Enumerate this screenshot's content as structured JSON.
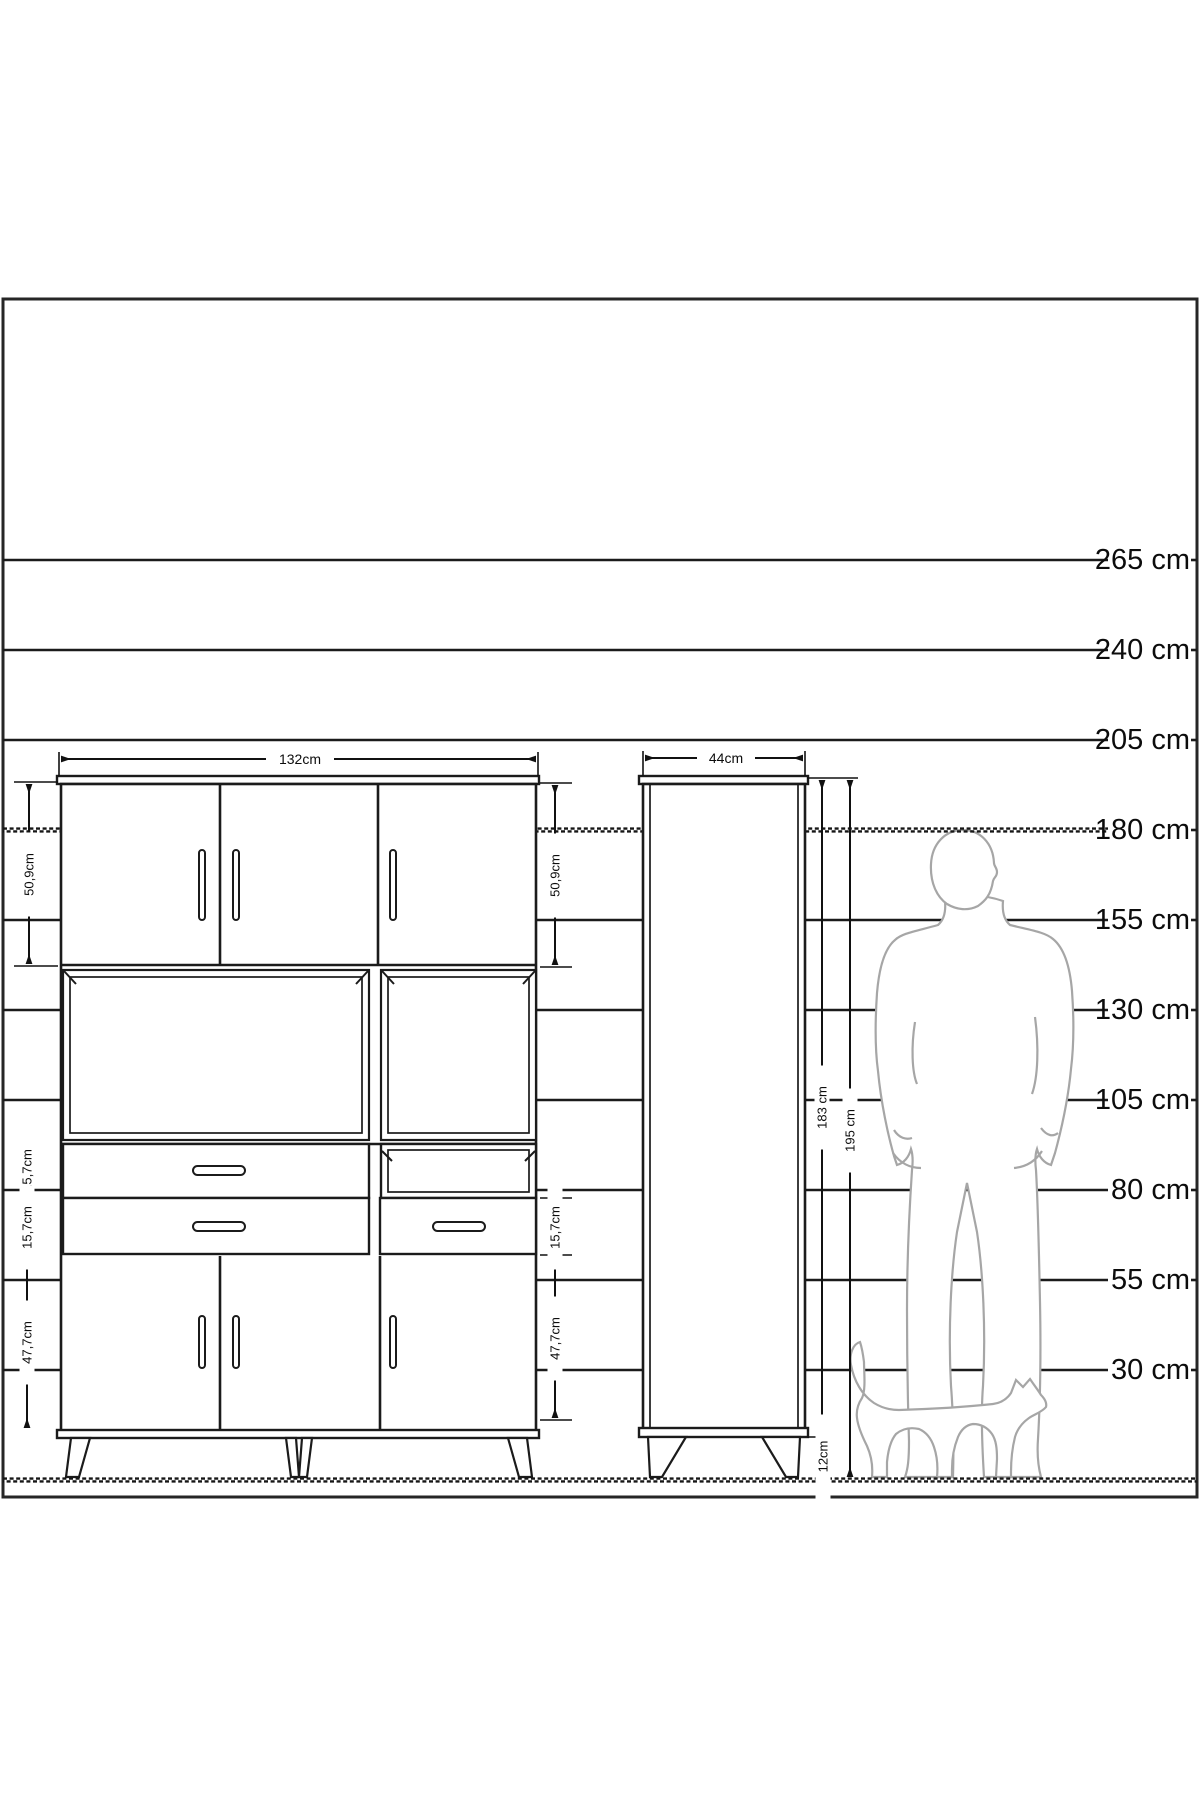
{
  "diagram": {
    "ruler": {
      "labels": [
        "265 cm",
        "240 cm",
        "205 cm",
        "180 cm",
        "155 cm",
        "130 cm",
        "105 cm",
        "80 cm",
        "55 cm",
        "30 cm"
      ]
    },
    "front_cabinet": {
      "width_label": "132cm",
      "upper_doors_height": "50,9cm",
      "drawer_row1_height": "15,7cm",
      "drawer_row2_height": "15,7cm",
      "lower_doors_height": "47,7cm",
      "right_upper_doors_height": "50,9cm",
      "right_drawer_height": "15,7cm",
      "right_lower_doors_height": "47,7cm"
    },
    "side_cabinet": {
      "depth_label": "44cm",
      "body_height_label": "183 cm",
      "total_height_label": "195 cm",
      "leg_height_label": "12cm"
    },
    "colors": {
      "line": "#1b1b1b",
      "silhouette": "#a6a6a6",
      "background": "#ffffff"
    }
  }
}
